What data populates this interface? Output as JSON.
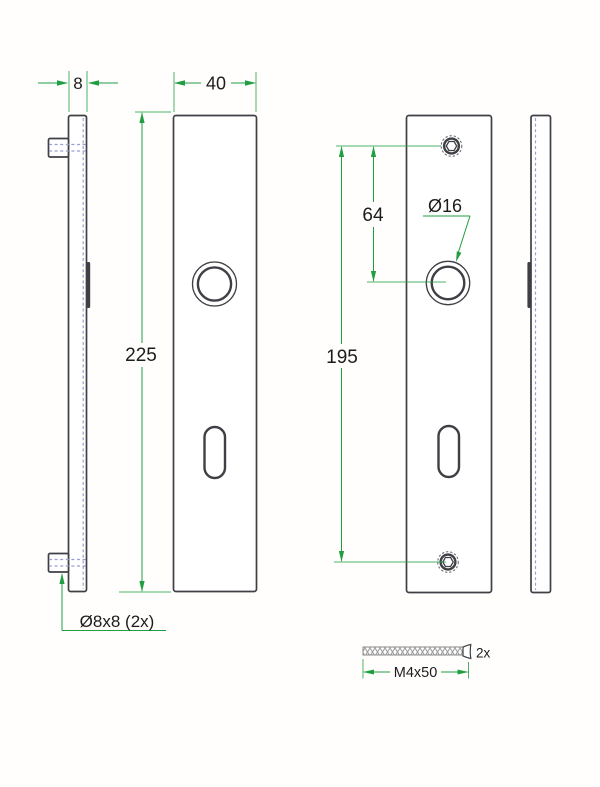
{
  "title": "Door plate technical drawing",
  "labels": {
    "thickness": "8",
    "plate_width": "40",
    "plate_height": "225",
    "top_hole_to_handle": "64",
    "hole_spacing": "195",
    "handle_hole_diameter": "Ø16",
    "stud_spec": "Ø8x8 (2x)",
    "screw_quantity": "2x",
    "screw_spec": "M4x50"
  },
  "colors": {
    "green": "#1f9e42",
    "ink": "#3f4045",
    "hidden": "#9b9ed1",
    "text": "#1c1c1c",
    "thread": "#9a9a9a"
  }
}
